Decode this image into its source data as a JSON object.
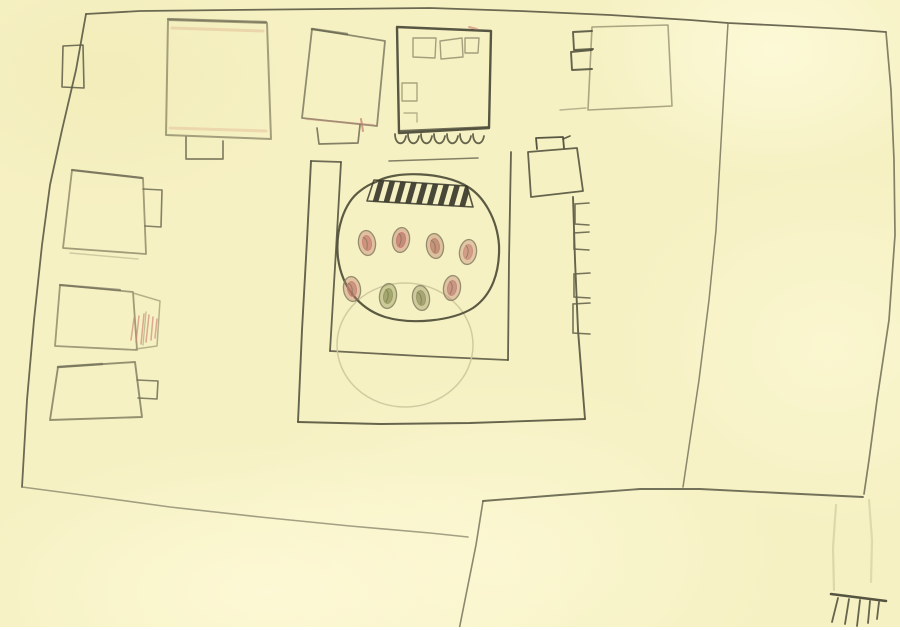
{
  "title": "Hand-drawn pencil map of a walled compound with courtyard garden, surrounding buildings, roads and paths on cream paper",
  "palette": {
    "paper": "#f6f1c3",
    "paper_light": "#fcf8d6",
    "paper_edge_white": "#ffffff",
    "pencil_dark": "#4e4d3b",
    "pencil_mid": "#6e6c55",
    "pencil_light": "#908c6b",
    "pencil_faint": "#cdc79b",
    "pale_path": "#dad6a8",
    "accent_red": "#c5796d",
    "accent_peach": "#e0b590",
    "accent_green": "#8f9357"
  },
  "map": {
    "central_garden": {
      "description": "rounded flower/tree bed inside inner courtyard",
      "tree_dots": [
        {
          "x": 367,
          "y": 243,
          "color": "#c4796c"
        },
        {
          "x": 401,
          "y": 240,
          "color": "#bd7268"
        },
        {
          "x": 435,
          "y": 246,
          "color": "#b97b66"
        },
        {
          "x": 468,
          "y": 252,
          "color": "#c98776"
        },
        {
          "x": 352,
          "y": 289,
          "color": "#c27d6e"
        },
        {
          "x": 388,
          "y": 296,
          "color": "#8f9357"
        },
        {
          "x": 421,
          "y": 298,
          "color": "#93915f"
        },
        {
          "x": 452,
          "y": 288,
          "color": "#c08073"
        }
      ],
      "hatch_band": {
        "stripes": 9,
        "start_x": 378,
        "step": 11,
        "color": "#3a392c"
      },
      "faint_circle": {
        "cx": 405,
        "cy": 345,
        "rx": 68,
        "ry": 62
      }
    },
    "arcade": {
      "scallops": 7,
      "start_x": 395,
      "step": 13,
      "y": 134
    },
    "right_wall_notches": 4,
    "rake": {
      "bar": [
        831,
        594,
        886,
        601
      ],
      "teeth": [
        [
          838,
          598,
          832,
          622
        ],
        [
          849,
          599,
          845,
          624
        ],
        [
          860,
          600,
          857,
          626
        ],
        [
          870,
          601,
          868,
          623
        ],
        [
          879,
          602,
          877,
          619
        ]
      ]
    },
    "buildings": [
      {
        "id": "top-left-building"
      },
      {
        "id": "top-middle-building"
      },
      {
        "id": "top-center-dark-building"
      },
      {
        "id": "top-right-building"
      },
      {
        "id": "left-building-upper"
      },
      {
        "id": "left-building-middle"
      },
      {
        "id": "left-building-lower"
      },
      {
        "id": "courtyard-corner-building"
      }
    ]
  }
}
